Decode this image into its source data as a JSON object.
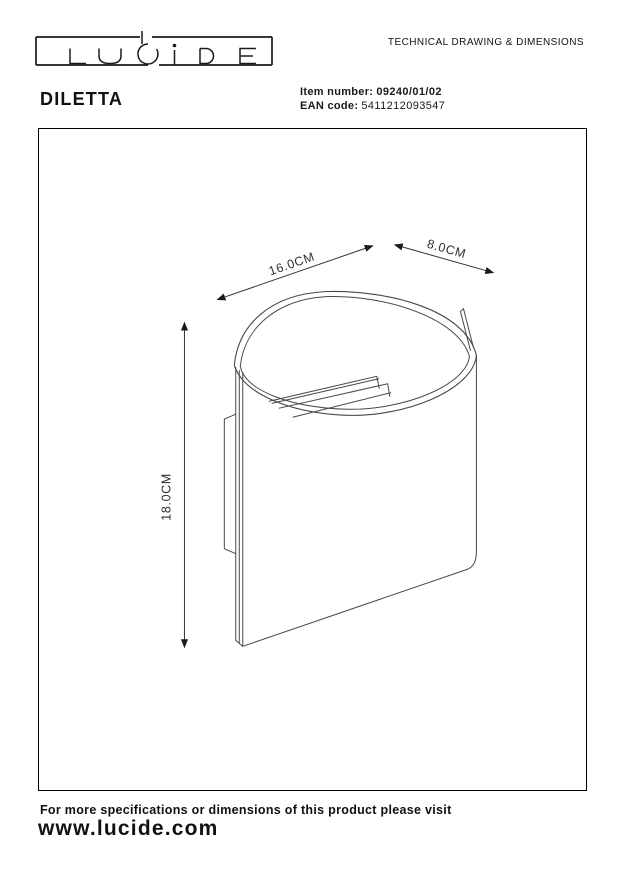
{
  "header": {
    "brand": "LUCIDE",
    "doc_title": "TECHNICAL DRAWING & DIMENSIONS",
    "product_name": "DILETTA",
    "item_number_label": "Item number:",
    "item_number_value": "09240/01/02",
    "ean_label": "EAN code:",
    "ean_value": "5411212093547"
  },
  "drawing": {
    "type": "technical-drawing-wall-lamp",
    "dim_width": "16.0CM",
    "dim_depth": "8.0CM",
    "dim_height": "18.0CM"
  },
  "footer": {
    "note": "For more specifications or dimensions of this product please visit",
    "website": "www.lucide.com"
  },
  "colors": {
    "ink": "#1a1a1a",
    "line": "#474747",
    "background": "#ffffff"
  }
}
